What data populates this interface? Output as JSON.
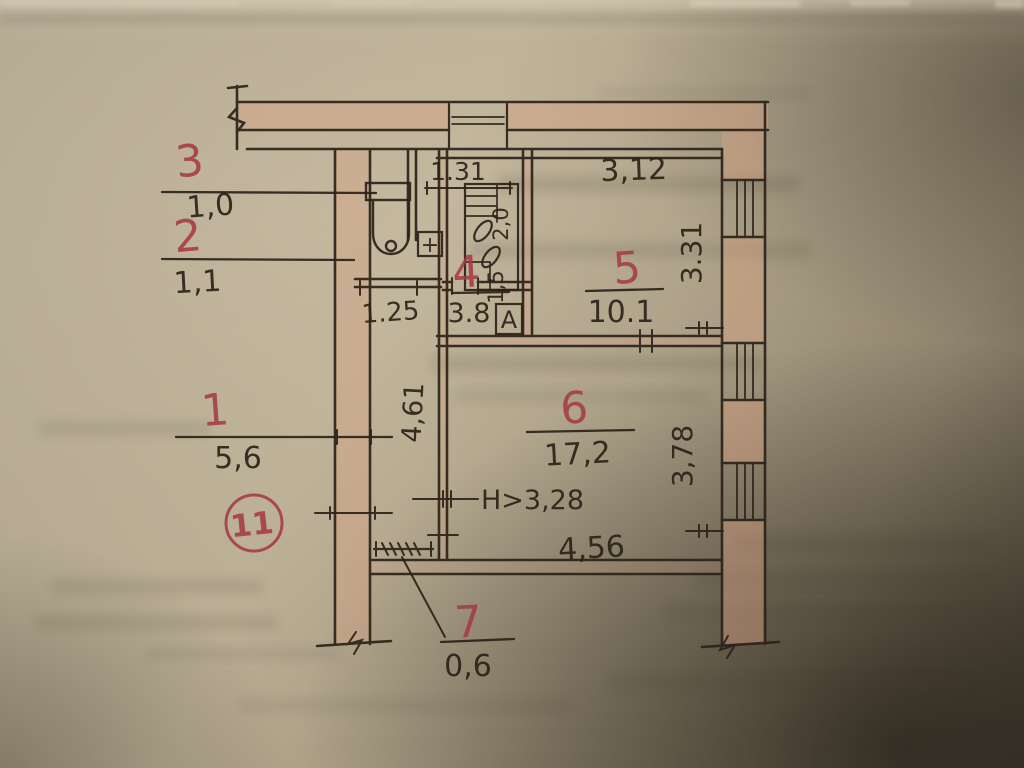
{
  "colors": {
    "ink": "#2b2219",
    "red_ink": "#a53b46",
    "wall_fill": "#d7a183",
    "paper": "#b0a48c"
  },
  "plan": {
    "apartment_badge": "11",
    "rooms": {
      "r1": {
        "num": "1",
        "area": "5,6"
      },
      "r2": {
        "num": "2",
        "area": "1,1"
      },
      "r3": {
        "num": "3",
        "area": "1,0"
      },
      "r4": {
        "num": "4",
        "area": "3.8"
      },
      "r5": {
        "num": "5",
        "area": "10.1"
      },
      "r6": {
        "num": "6",
        "area": "17,2"
      },
      "r7": {
        "num": "7",
        "area": "0,6"
      }
    },
    "dims": {
      "niche_width": "1.31",
      "top_width": "3,12",
      "right_upper": "3.31",
      "right_lower": "3,78",
      "bottom_width": "4,56",
      "hall_length": "4,61",
      "hall_width": "1.25",
      "ceiling_height": "Н>3,28",
      "vent_depth": "2,0",
      "vent_width": "1,5"
    },
    "marks": {
      "closet": "А",
      "fixture_plus": "+"
    }
  }
}
